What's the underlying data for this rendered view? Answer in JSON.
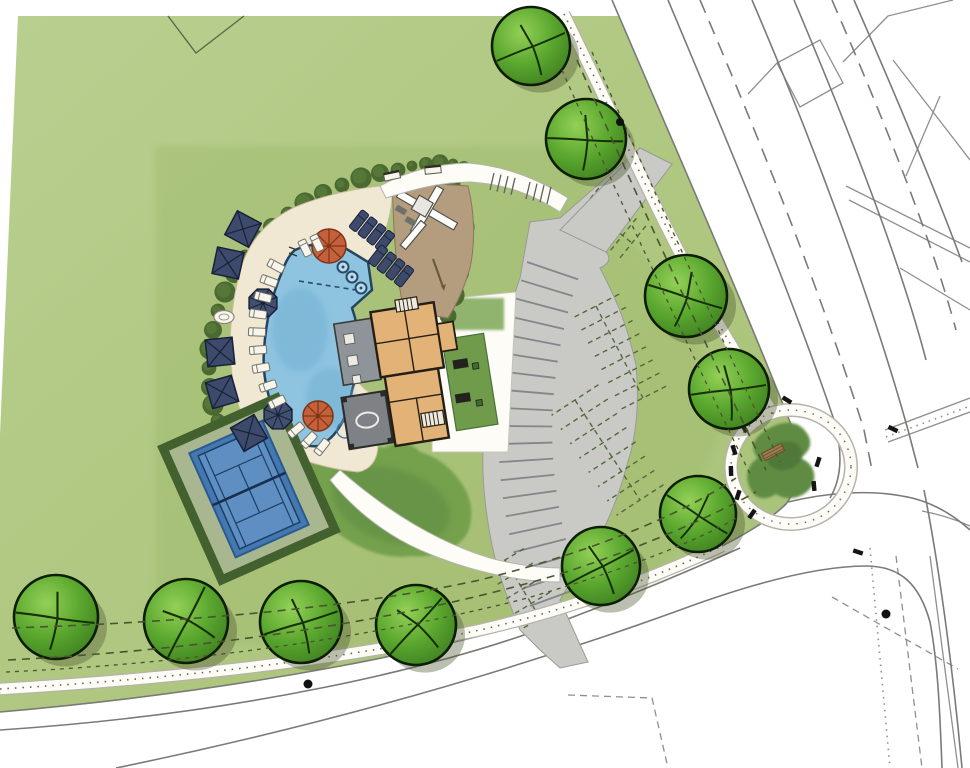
{
  "canvas": {
    "width": 970,
    "height": 768
  },
  "plan": {
    "type": "landscape-site-plan",
    "features": [
      "pool",
      "pool-deck",
      "tennis-court",
      "clubhouse",
      "playground",
      "parking-lot",
      "corner-garden",
      "roads",
      "sidewalks",
      "street-trees"
    ]
  },
  "palette": {
    "paper": "#ffffff",
    "field1": "#b7cd8c",
    "field2": "#aac379",
    "parcel": "#a3bd72",
    "hedge": "#4b6a31",
    "hedgeLight": "#5f813e",
    "lawn": "#74a14e",
    "lawnDark": "#5f8c42",
    "deck": "#f1e8d3",
    "deckEdge": "#c9bb9c",
    "sand": "#b49c7e",
    "sandEdge": "#8a7758",
    "pool": "#8ec4e0",
    "poolDeep": "#6fafd2",
    "poolEdge": "#24455e",
    "tennisSurround": "#a9b795",
    "tennisHedge": "#42612e",
    "tennisCourt": "#4478b0",
    "tennisCourtLight": "#5e8ec2",
    "tennisLine": "#1d3f66",
    "bldgTan": "#e2b277",
    "bldgWall": "#241f16",
    "porchGray": "#8f949a",
    "porchDark": "#7e8287",
    "parking": "#c9cac6",
    "stripe": "#84868a",
    "stall": "#55683c",
    "roadLine": "#7a7a76",
    "offsite": "#8f8f8d",
    "sidewalk": "#fdfcf7",
    "sidewalkEdge": "#b5b3aa",
    "stipple": "#4a473e",
    "utility": "#49552f",
    "navy": "#3d4a6b",
    "navyDark": "#18213a",
    "orange": "#c4613b",
    "orangeDark": "#7e3318",
    "white": "#f8f5ec",
    "tick": "#141414",
    "treeEdge": "#0d1d06",
    "branch": "#163009",
    "benchWood": "#9c7b50"
  },
  "trees": [
    {
      "x": 531,
      "y": 46,
      "r": 39,
      "rot": 15
    },
    {
      "x": 586,
      "y": 139,
      "r": 40,
      "rot": 40
    },
    {
      "x": 686,
      "y": 296,
      "r": 41,
      "rot": 55
    },
    {
      "x": 729,
      "y": 389,
      "r": 40,
      "rot": 30
    },
    {
      "x": 698,
      "y": 514,
      "r": 38,
      "rot": 70
    },
    {
      "x": 601,
      "y": 566,
      "r": 39,
      "rot": 10
    },
    {
      "x": 416,
      "y": 625,
      "r": 40,
      "rot": -10
    },
    {
      "x": 301,
      "y": 622,
      "r": 41,
      "rot": 20
    },
    {
      "x": 186,
      "y": 621,
      "r": 42,
      "rot": -25
    },
    {
      "x": 56,
      "y": 617,
      "r": 42,
      "rot": 45
    }
  ],
  "furniture": {
    "shade_squares": [
      {
        "x": 243,
        "y": 229,
        "rot": 28
      },
      {
        "x": 228,
        "y": 263,
        "rot": 12
      },
      {
        "x": 220,
        "y": 352,
        "rot": -6
      },
      {
        "x": 222,
        "y": 392,
        "rot": -16
      },
      {
        "x": 249,
        "y": 433,
        "rot": -30
      }
    ],
    "navy_umbrellas": [
      {
        "x": 263,
        "y": 303,
        "r": 15
      },
      {
        "x": 278,
        "y": 415,
        "r": 15
      }
    ],
    "orange_umbrellas": [
      {
        "x": 329,
        "y": 246,
        "r": 17
      },
      {
        "x": 318,
        "y": 416,
        "r": 15
      }
    ],
    "white_loungers": [
      {
        "x": 276,
        "y": 266,
        "rot": 28
      },
      {
        "x": 269,
        "y": 281,
        "rot": 20
      },
      {
        "x": 263,
        "y": 297,
        "rot": 14
      },
      {
        "x": 258,
        "y": 314,
        "rot": 8
      },
      {
        "x": 257,
        "y": 332,
        "rot": 2
      },
      {
        "x": 258,
        "y": 350,
        "rot": -4
      },
      {
        "x": 261,
        "y": 368,
        "rot": -10
      },
      {
        "x": 268,
        "y": 386,
        "rot": -18
      },
      {
        "x": 277,
        "y": 402,
        "rot": -26
      },
      {
        "x": 296,
        "y": 430,
        "rot": -40
      },
      {
        "x": 309,
        "y": 440,
        "rot": -46
      },
      {
        "x": 322,
        "y": 447,
        "rot": -52
      },
      {
        "x": 305,
        "y": 248,
        "rot": 64
      },
      {
        "x": 317,
        "y": 243,
        "rot": 64
      }
    ],
    "navy_lounger_groups": [
      {
        "x": 372,
        "y": 231,
        "rot": 38
      },
      {
        "x": 391,
        "y": 266,
        "rot": 38
      }
    ],
    "tables": [
      {
        "x": 224,
        "y": 317
      }
    ],
    "walk_benches": [
      {
        "x": 392,
        "y": 176,
        "rot": -12
      },
      {
        "x": 433,
        "y": 170,
        "rot": -6
      }
    ],
    "corner_bench": {
      "x": 773,
      "y": 452,
      "rot": -28
    }
  },
  "spa_jets": [
    {
      "x": 343,
      "y": 267
    },
    {
      "x": 352,
      "y": 277
    },
    {
      "x": 361,
      "y": 288
    }
  ],
  "hedge_arcs": [
    {
      "r": 9,
      "pts": [
        [
          398,
          170
        ],
        [
          380,
          173
        ],
        [
          361,
          178
        ],
        [
          342,
          185
        ],
        [
          323,
          193
        ],
        [
          305,
          203
        ],
        [
          288,
          214
        ],
        [
          272,
          227
        ],
        [
          258,
          241
        ],
        [
          245,
          257
        ],
        [
          234,
          274
        ],
        [
          225,
          292
        ],
        [
          218,
          311
        ],
        [
          213,
          330
        ],
        [
          210,
          349
        ],
        [
          209,
          368
        ],
        [
          210,
          387
        ],
        [
          213,
          405
        ],
        [
          218,
          421
        ],
        [
          225,
          436
        ]
      ]
    },
    {
      "r": 10,
      "pts": [
        [
          452,
          184
        ],
        [
          459,
          205
        ],
        [
          463,
          227
        ],
        [
          463,
          250
        ],
        [
          459,
          273
        ],
        [
          453,
          295
        ],
        [
          448,
          316
        ],
        [
          446,
          336
        ]
      ]
    },
    {
      "r": 7,
      "pts": [
        [
          412,
          166
        ],
        [
          426,
          164
        ],
        [
          440,
          163
        ],
        [
          453,
          164
        ],
        [
          464,
          168
        ]
      ]
    }
  ],
  "parking": {
    "stripe_curve": {
      "p0": [
        527,
        262
      ],
      "p1": [
        468,
        436
      ],
      "p2": [
        530,
        606
      ]
    },
    "stripe_count": 20,
    "stripe_len": 54,
    "stall_clusters": [
      {
        "x1": 585,
        "y1": 205,
        "x2": 632,
        "y2": 243,
        "n": 5,
        "len": 22
      },
      {
        "x1": 596,
        "y1": 306,
        "x2": 643,
        "y2": 398,
        "n": 7,
        "len": 26
      },
      {
        "x1": 575,
        "y1": 400,
        "x2": 640,
        "y2": 500,
        "n": 7,
        "len": 28
      },
      {
        "x1": 505,
        "y1": 560,
        "x2": 540,
        "y2": 618,
        "n": 4,
        "len": 22
      }
    ]
  },
  "ticks": [
    {
      "x": 744,
      "y": 428,
      "rot": 55
    },
    {
      "x": 734,
      "y": 450,
      "rot": 72
    },
    {
      "x": 731,
      "y": 471,
      "rot": 88
    },
    {
      "x": 738,
      "y": 495,
      "rot": 108
    },
    {
      "x": 752,
      "y": 514,
      "rot": 125
    },
    {
      "x": 818,
      "y": 462,
      "rot": -72
    },
    {
      "x": 814,
      "y": 486,
      "rot": -95
    },
    {
      "x": 787,
      "y": 400,
      "rot": 32
    },
    {
      "x": 893,
      "y": 429,
      "rot": 25
    },
    {
      "x": 858,
      "y": 552,
      "rot": 18
    }
  ],
  "dots": [
    {
      "x": 620,
      "y": 122,
      "r": 4
    },
    {
      "x": 308,
      "y": 684,
      "r": 4.5
    },
    {
      "x": 886,
      "y": 614,
      "r": 4.5
    }
  ]
}
